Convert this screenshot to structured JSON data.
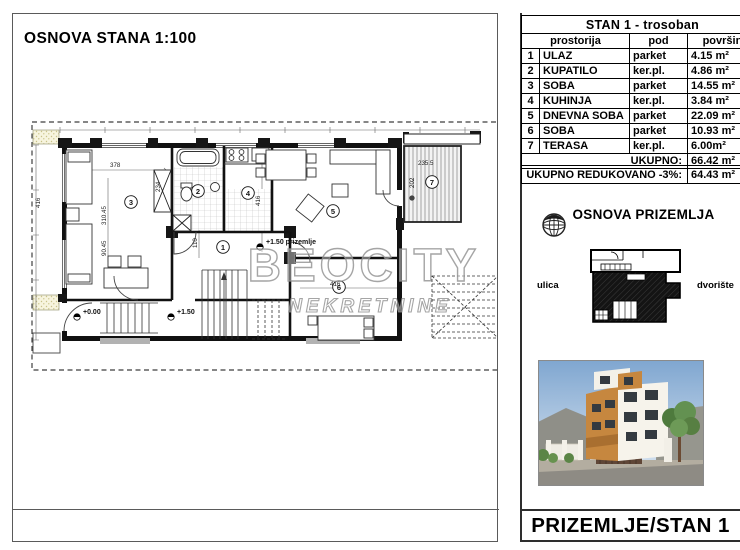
{
  "left_panel": {
    "title": "OSNOVA STANA 1:100",
    "watermark": {
      "line1": "BEOCITY",
      "line2": "NEKRETNINE"
    },
    "plan": {
      "rooms": {
        "r1": "1",
        "r2": "2",
        "r3": "3",
        "r4": "4",
        "r5": "5",
        "r6": "6",
        "r7": "7"
      },
      "elevations": {
        "ground": "+0.00",
        "upper": "+1.50",
        "note": "+1.50 prizemlje"
      },
      "dimensions": {
        "d1": "378",
        "d2": "310.45",
        "d3": "90.45",
        "d4": "234",
        "d5": "110",
        "d6": "416",
        "d7": "416",
        "d8": "416",
        "d9": "235.5",
        "d10": "202"
      }
    }
  },
  "right_panel": {
    "table": {
      "title": "STAN 1 - trosoban",
      "col_headers": {
        "room": "prostorija",
        "floor": "pod",
        "area": "površina"
      },
      "rows": [
        {
          "num": "1",
          "room": "ULAZ",
          "floor": "parket",
          "area": "4.15 m²"
        },
        {
          "num": "2",
          "room": "KUPATILO",
          "floor": "ker.pl.",
          "area": "4.86 m²"
        },
        {
          "num": "3",
          "room": "SOBA",
          "floor": "parket",
          "area": "14.55 m²"
        },
        {
          "num": "4",
          "room": "KUHINJA",
          "floor": "ker.pl.",
          "area": "3.84 m²"
        },
        {
          "num": "5",
          "room": "DNEVNA SOBA",
          "floor": "parket",
          "area": "22.09 m²"
        },
        {
          "num": "6",
          "room": "SOBA",
          "floor": "parket",
          "area": "10.93 m²"
        },
        {
          "num": "7",
          "room": "TERASA",
          "floor": "ker.pl.",
          "area": "6.00m²"
        }
      ],
      "total_label": "UKUPNO:",
      "total_value": "66.42 m²",
      "reduced_label": "UKUPNO REDUKOVANO -3%:",
      "reduced_value": "64.43 m²"
    },
    "site_section": {
      "title": "OSNOVA PRIZEMLJA",
      "street_label": "ulica",
      "yard_label": "dvorište"
    },
    "footer_label": "PRIZEMLJE/STAN 1"
  },
  "colors": {
    "accent_orange": "#c6873f",
    "sky_blue": "#9db9d8",
    "tree_green": "#5d8a46",
    "watermark_gray": "#8f8f8f",
    "line_black": "#000000"
  }
}
